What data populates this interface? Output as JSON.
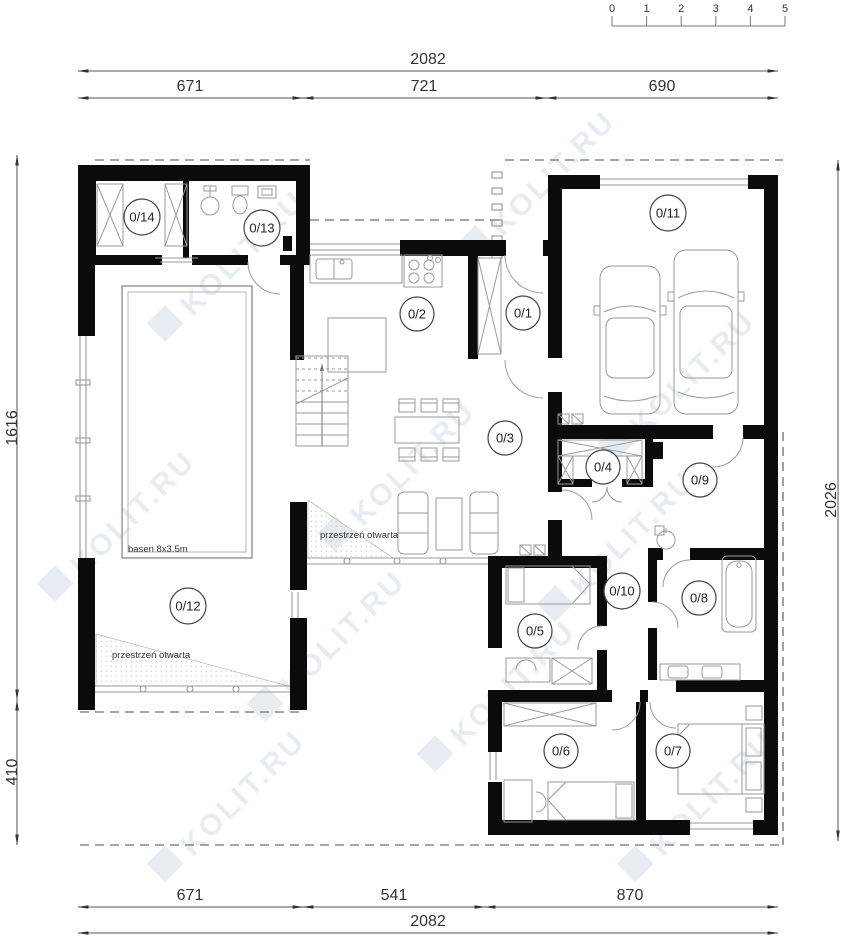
{
  "scale_bar": {
    "ticks": [
      "0",
      "1",
      "2",
      "3",
      "4",
      "5"
    ]
  },
  "dimensions": {
    "top_total": "2082",
    "top_segments": [
      "671",
      "721",
      "690"
    ],
    "bottom_segments": [
      "671",
      "541",
      "870"
    ],
    "bottom_total": "2082",
    "left_upper": "1616",
    "left_lower": "410",
    "right": "2026"
  },
  "rooms": [
    {
      "id": "0/1"
    },
    {
      "id": "0/2"
    },
    {
      "id": "0/3"
    },
    {
      "id": "0/4"
    },
    {
      "id": "0/5"
    },
    {
      "id": "0/6"
    },
    {
      "id": "0/7"
    },
    {
      "id": "0/8"
    },
    {
      "id": "0/9"
    },
    {
      "id": "0/10"
    },
    {
      "id": "0/11"
    },
    {
      "id": "0/12"
    },
    {
      "id": "0/13"
    },
    {
      "id": "0/14"
    }
  ],
  "annotations": {
    "pool": "basen 8x3.5m",
    "open_space_left": "przestrzeń otwarta",
    "open_space_center": "przestrzeń otwarta"
  },
  "watermark": {
    "text": "KOLIT.RU"
  },
  "colors": {
    "wall": "#0b0b0b",
    "thin_line": "#999999",
    "dimension": "#333333",
    "dashed": "#888888",
    "watermark": "#d3dde8",
    "background": "#ffffff"
  }
}
